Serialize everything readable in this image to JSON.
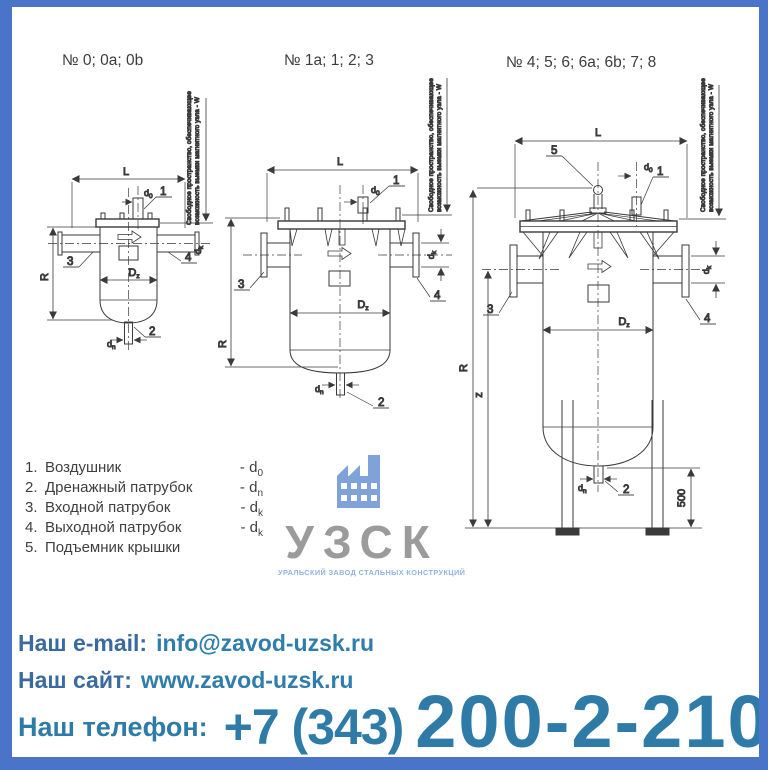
{
  "titles": {
    "t1": "№ 0; 0a; 0b",
    "t2": "№ 1a; 1; 2; 3",
    "t3": "№ 4; 5; 6; 6a; 6b; 7; 8"
  },
  "note": {
    "line1": "Свободное пространство, обеспечивающее",
    "line2": "возможность выемки магнитного узла - W"
  },
  "dims": {
    "L": "L",
    "R": "R",
    "z": "z",
    "D_base": "D",
    "D_sub": "z",
    "d_base": "d",
    "d0_sub": "0",
    "dn_sub": "n",
    "dk_sub": "k",
    "leg_height": "500"
  },
  "parts": {
    "p1": "1",
    "p2": "2",
    "p3": "3",
    "p4": "4",
    "p5": "5"
  },
  "legend": {
    "items": [
      {
        "num": "1.",
        "name": "Воздушник",
        "dash": "- ",
        "sym": "d",
        "sub": "0"
      },
      {
        "num": "2.",
        "name": "Дренажный патрубок",
        "dash": "- ",
        "sym": "d",
        "sub": "n"
      },
      {
        "num": "3.",
        "name": "Входной патрубок",
        "dash": "- ",
        "sym": "d",
        "sub": "k"
      },
      {
        "num": "4.",
        "name": "Выходной патрубок",
        "dash": "- ",
        "sym": "d",
        "sub": "k"
      },
      {
        "num": "5.",
        "name": "Подъемник крышки",
        "dash": "",
        "sym": "",
        "sub": ""
      }
    ]
  },
  "logo": {
    "acronym": "УЗСК",
    "subtitle": "УРАЛЬСКИЙ ЗАВОД СТАЛЬНЫХ КОНСТРУКЦИЙ"
  },
  "contacts": {
    "email_label": "Наш e-mail:",
    "email_value": "info@zavod-uzsk.ru",
    "site_label": "Наш сайт:",
    "site_value": "www.zavod-uzsk.ru",
    "phone_label": "Наш телефон:",
    "phone_code": "+7 (343)",
    "phone_number": "200-2-210"
  },
  "colors": {
    "frame": "#4a74c8",
    "accent_teal": "#2e7ba7",
    "label_blue": "#3a6b9e",
    "logo_gray": "#9b9b9b",
    "logo_blue": "#7fa3d8",
    "line": "#3a3a3a"
  }
}
